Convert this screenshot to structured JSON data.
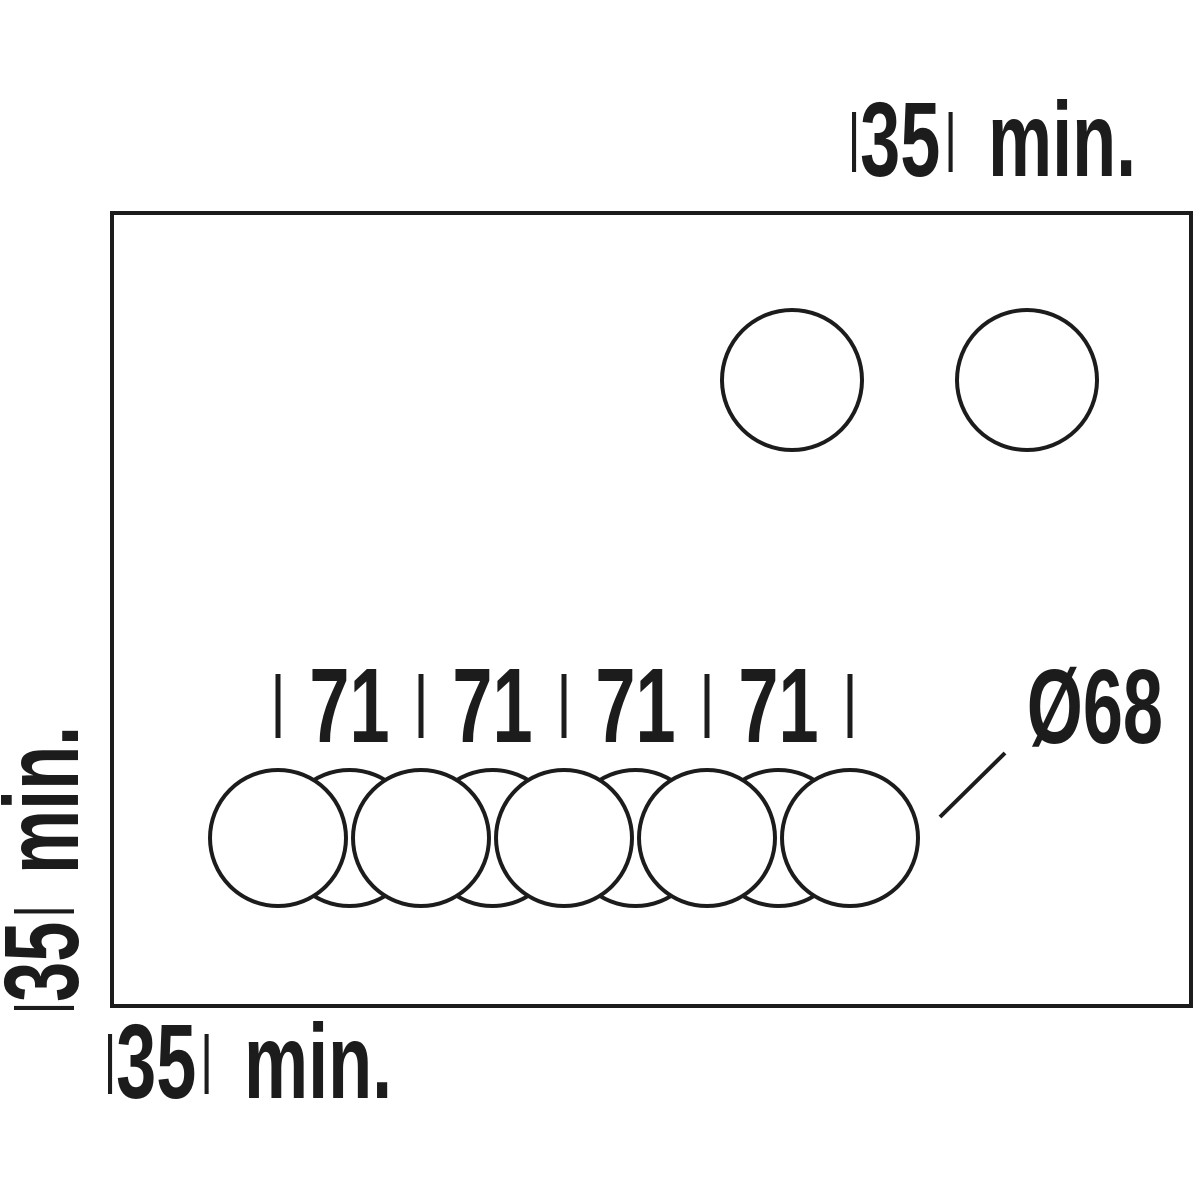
{
  "drawing": {
    "kind": "installation-cutout-template",
    "colors": {
      "ink": "#1c1c1c",
      "background": "#ffffff"
    },
    "dimensions": {
      "top_clearance": {
        "value": "35",
        "unit": "min."
      },
      "left_clearance": {
        "value": "35",
        "unit": "min."
      },
      "bottom_clearance": {
        "value": "35",
        "unit": "min."
      },
      "hole_diameter": "Ø68",
      "spacings": [
        "71",
        "71",
        "71",
        "71"
      ]
    }
  }
}
